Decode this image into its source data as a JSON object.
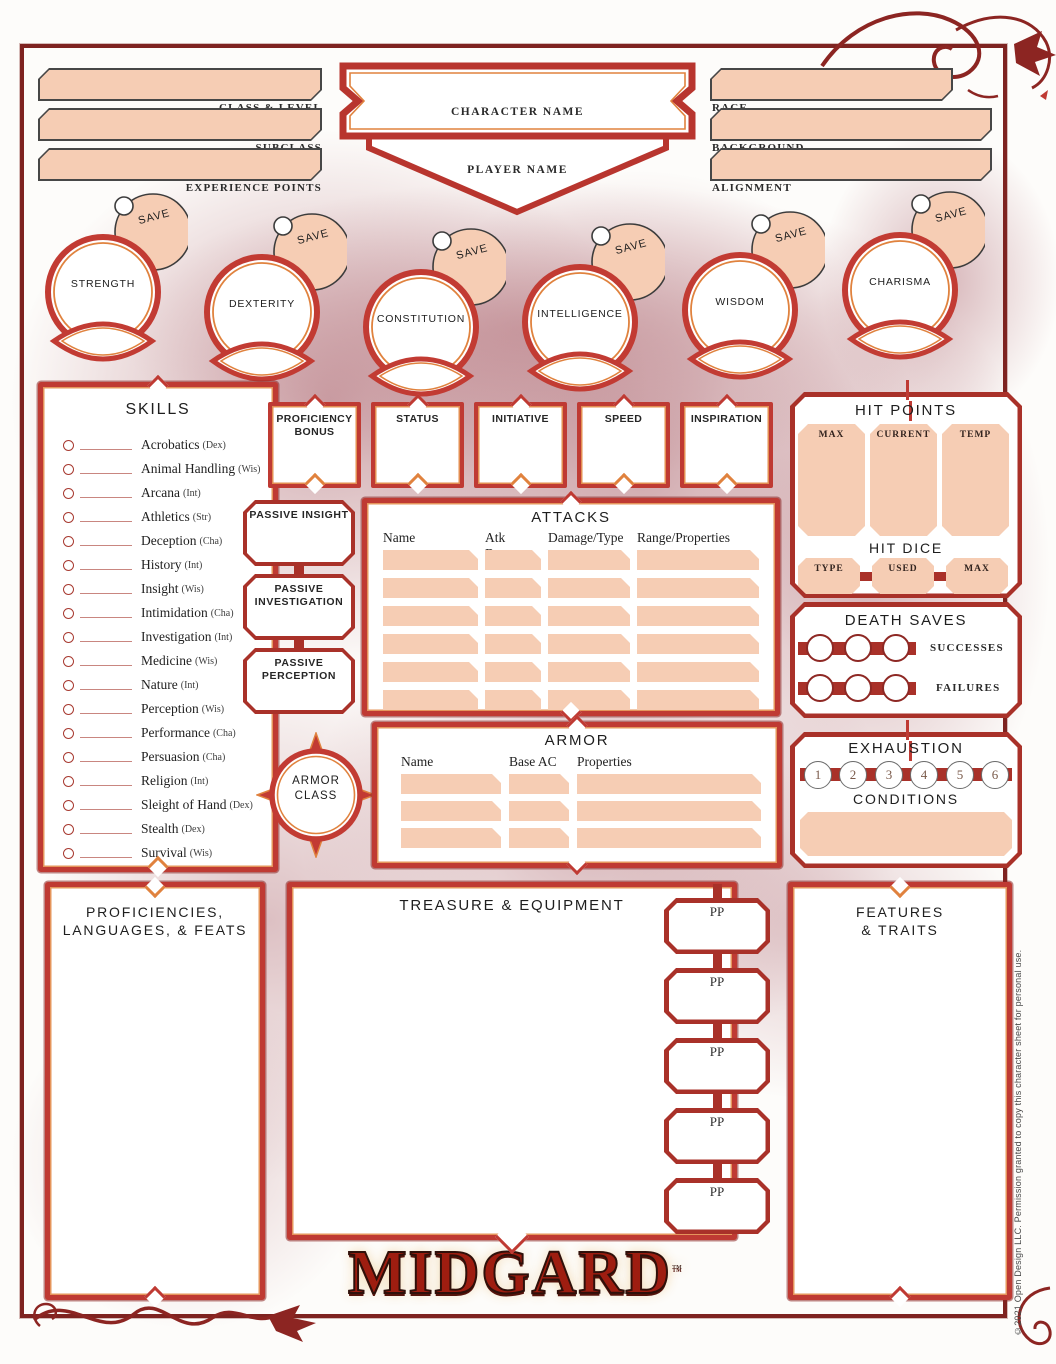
{
  "colors": {
    "accent_red": "#bf3a33",
    "accent_orange": "#e0823e",
    "peach_fill": "#f6cdb4",
    "frame_maroon": "#7e2320"
  },
  "header": {
    "left_fields": [
      {
        "label": "CLASS & LEVEL"
      },
      {
        "label": "SUBCLASS"
      },
      {
        "label": "EXPERIENCE POINTS"
      }
    ],
    "center_fields": {
      "character_name_label": "CHARACTER NAME",
      "player_name_label": "PLAYER NAME"
    },
    "right_fields": [
      {
        "label": "RACE"
      },
      {
        "label": "BACKGROUND"
      },
      {
        "label": "ALIGNMENT"
      }
    ]
  },
  "abilities": {
    "save_label": "SAVE",
    "list": [
      {
        "name": "STRENGTH"
      },
      {
        "name": "DEXTERITY"
      },
      {
        "name": "CONSTITUTION"
      },
      {
        "name": "INTELLIGENCE"
      },
      {
        "name": "WISDOM"
      },
      {
        "name": "CHARISMA"
      }
    ]
  },
  "skills": {
    "title": "SKILLS",
    "items": [
      {
        "name": "Acrobatics",
        "abbr": "(Dex)"
      },
      {
        "name": "Animal Handling",
        "abbr": "(Wis)"
      },
      {
        "name": "Arcana",
        "abbr": "(Int)"
      },
      {
        "name": "Athletics",
        "abbr": "(Str)"
      },
      {
        "name": "Deception",
        "abbr": "(Cha)"
      },
      {
        "name": "History",
        "abbr": "(Int)"
      },
      {
        "name": "Insight",
        "abbr": "(Wis)"
      },
      {
        "name": "Intimidation",
        "abbr": "(Cha)"
      },
      {
        "name": "Investigation",
        "abbr": "(Int)"
      },
      {
        "name": "Medicine",
        "abbr": "(Wis)"
      },
      {
        "name": "Nature",
        "abbr": "(Int)"
      },
      {
        "name": "Perception",
        "abbr": "(Wis)"
      },
      {
        "name": "Performance",
        "abbr": "(Cha)"
      },
      {
        "name": "Persuasion",
        "abbr": "(Cha)"
      },
      {
        "name": "Religion",
        "abbr": "(Int)"
      },
      {
        "name": "Sleight of Hand",
        "abbr": "(Dex)"
      },
      {
        "name": "Stealth",
        "abbr": "(Dex)"
      },
      {
        "name": "Survival",
        "abbr": "(Wis)"
      }
    ]
  },
  "stat_boxes": [
    "PROFICIENCY BONUS",
    "STATUS",
    "INITIATIVE",
    "SPEED",
    "INSPIRATION"
  ],
  "passive_boxes": [
    "PASSIVE INSIGHT",
    "PASSIVE INVESTIGATION",
    "PASSIVE PERCEPTION"
  ],
  "attacks": {
    "title": "ATTACKS",
    "columns": [
      "Name",
      "Atk Bonus",
      "Damage/Type",
      "Range/Properties"
    ]
  },
  "hit_points": {
    "title": "HIT POINTS",
    "columns": [
      "MAX",
      "CURRENT",
      "TEMP"
    ],
    "hit_dice": {
      "title": "HIT DICE",
      "columns": [
        "TYPE",
        "USED",
        "MAX"
      ]
    }
  },
  "death_saves": {
    "title": "DEATH SAVES",
    "success_label": "SUCCESSES",
    "failure_label": "FAILURES"
  },
  "armor_class": {
    "line1": "ARMOR",
    "line2": "CLASS"
  },
  "armor": {
    "title": "ARMOR",
    "columns": [
      "Name",
      "Base AC",
      "Properties"
    ]
  },
  "exhaustion": {
    "title": "EXHAUSTION",
    "levels": [
      "1",
      "2",
      "3",
      "4",
      "5",
      "6"
    ],
    "conditions_label": "CONDITIONS"
  },
  "proficiencies": {
    "title_line1": "PROFICIENCIES,",
    "title_line2": "LANGUAGES, & FEATS"
  },
  "treasure": {
    "title": "TREASURE & EQUIPMENT",
    "currency": [
      "PP",
      "PP",
      "PP",
      "PP",
      "PP"
    ]
  },
  "features": {
    "title_line1": "FEATURES",
    "title_line2": "& TRAITS"
  },
  "logo": {
    "text": "MIDGARD",
    "tm": "™"
  },
  "footer": {
    "copyright": "©2021 Open Design LLC. Permission granted to copy this character sheet for personal use."
  }
}
